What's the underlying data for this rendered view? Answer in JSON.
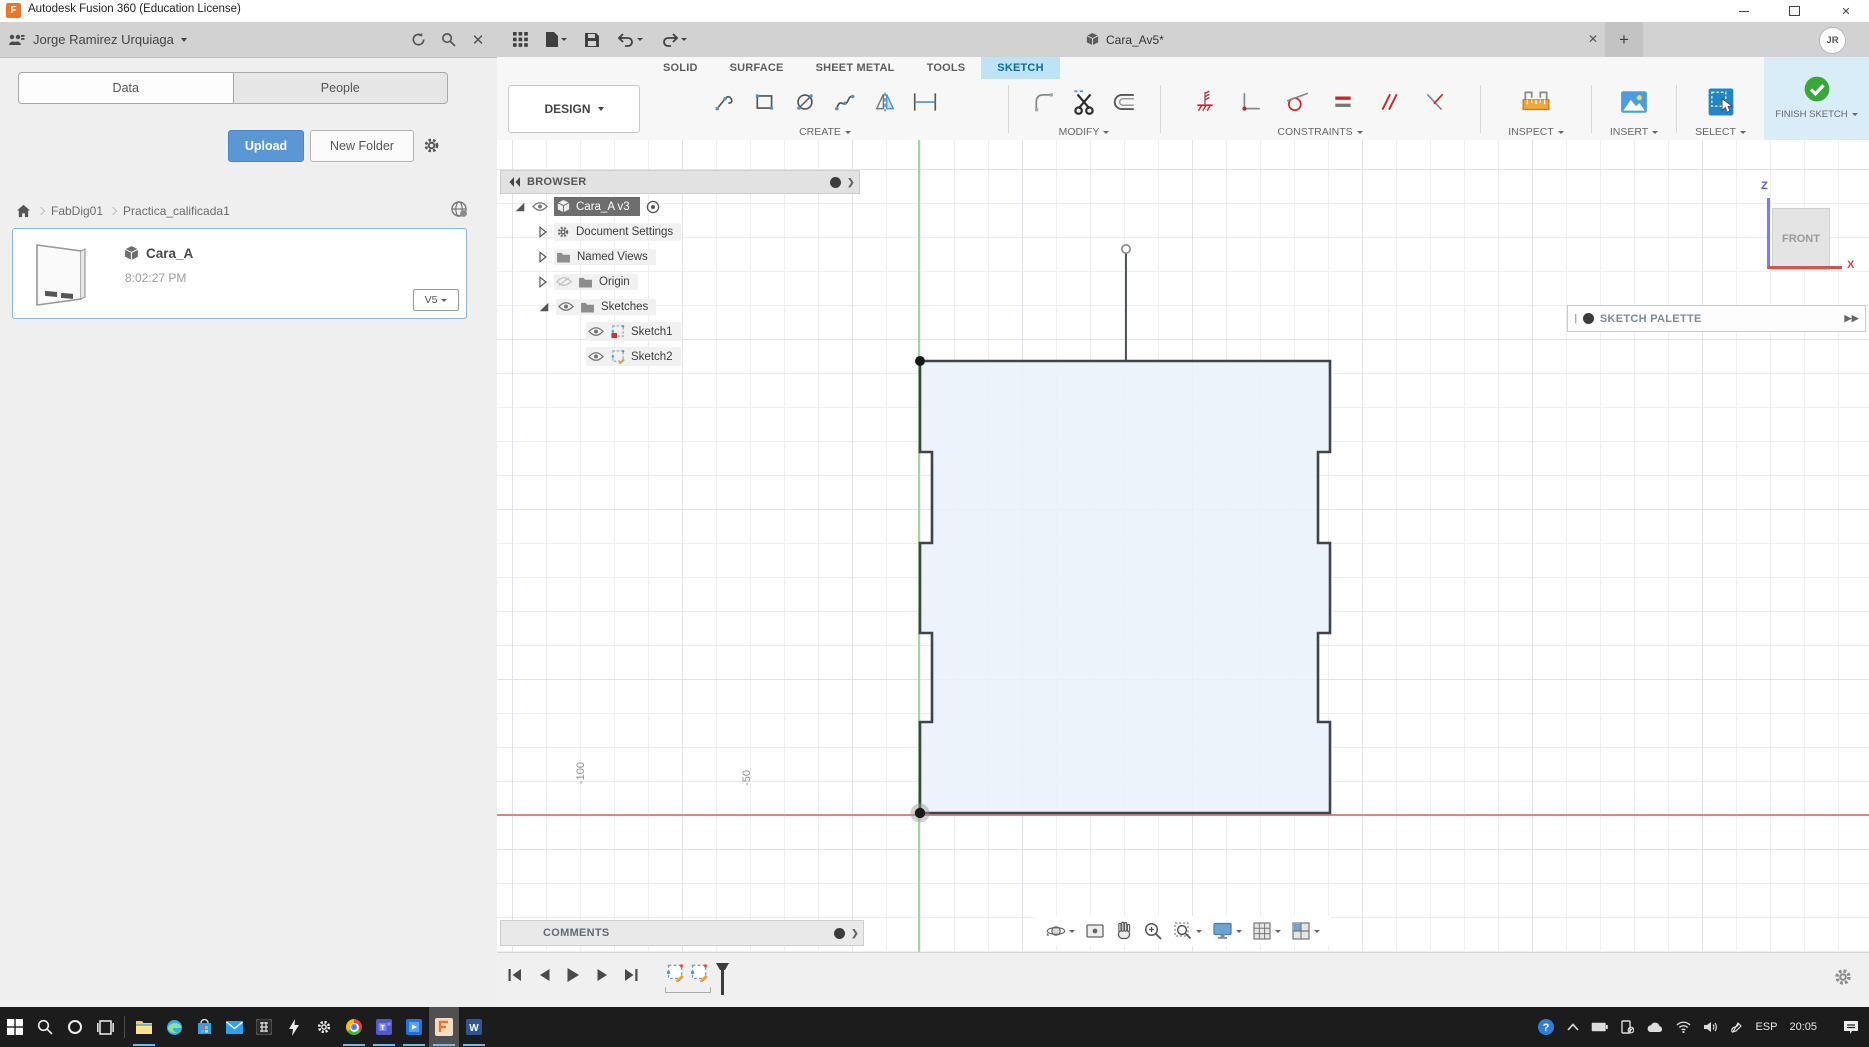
{
  "window": {
    "title": "Autodesk Fusion 360 (Education License)"
  },
  "data_panel": {
    "team_name": "Jorge Ramirez Urquiaga",
    "tab_data": "Data",
    "tab_people": "People",
    "upload_label": "Upload",
    "new_folder_label": "New Folder",
    "breadcrumb": [
      "FabDig01",
      "Practica_calificada1"
    ],
    "file_card": {
      "name": "Cara_A",
      "time": "8:02:27 PM",
      "version": "V5"
    }
  },
  "app_bar": {
    "document_tab": "Cara_Av5*",
    "new_tab_glyph": "+",
    "avatar_initials": "JR"
  },
  "ribbon": {
    "workspace_label": "DESIGN",
    "tabs": [
      {
        "label": "SOLID"
      },
      {
        "label": "SURFACE"
      },
      {
        "label": "SHEET METAL"
      },
      {
        "label": "TOOLS"
      },
      {
        "label": "SKETCH"
      }
    ],
    "group_create": "CREATE",
    "group_modify": "MODIFY",
    "group_constraints": "CONSTRAINTS",
    "group_inspect": "INSPECT",
    "group_insert": "INSERT",
    "group_select": "SELECT",
    "finish_sketch_label": "FINISH SKETCH"
  },
  "browser": {
    "title": "BROWSER",
    "root_item": "Cara_A v3",
    "items": [
      {
        "label": "Document Settings"
      },
      {
        "label": "Named Views"
      },
      {
        "label": "Origin"
      },
      {
        "label": "Sketches"
      },
      {
        "label": "Sketch1"
      },
      {
        "label": "Sketch2"
      }
    ]
  },
  "canvas": {
    "axis_tick_neg100": "-100",
    "axis_tick_neg50": "-50",
    "viewcube_face": "FRONT",
    "axis_z_label": "Z",
    "axis_x_label": "X",
    "sketch_palette_title": "SKETCH PALETTE"
  },
  "comments_panel": {
    "title": "COMMENTS"
  },
  "taskbar": {
    "language": "ESP",
    "time": "20:05"
  },
  "colors": {
    "accent_blue": "#0d6a9e",
    "tab_highlight": "#bfe3f6",
    "upload_blue": "#5b97d4",
    "finish_panel": "#d9edf8",
    "finish_green": "#37a93c",
    "axis_red": "#e08383",
    "axis_green": "#a3d6a3",
    "sketch_fill": "#e9f1f9",
    "select_blue": "#2285c4",
    "taskbar_bg": "#1c1c1c"
  }
}
